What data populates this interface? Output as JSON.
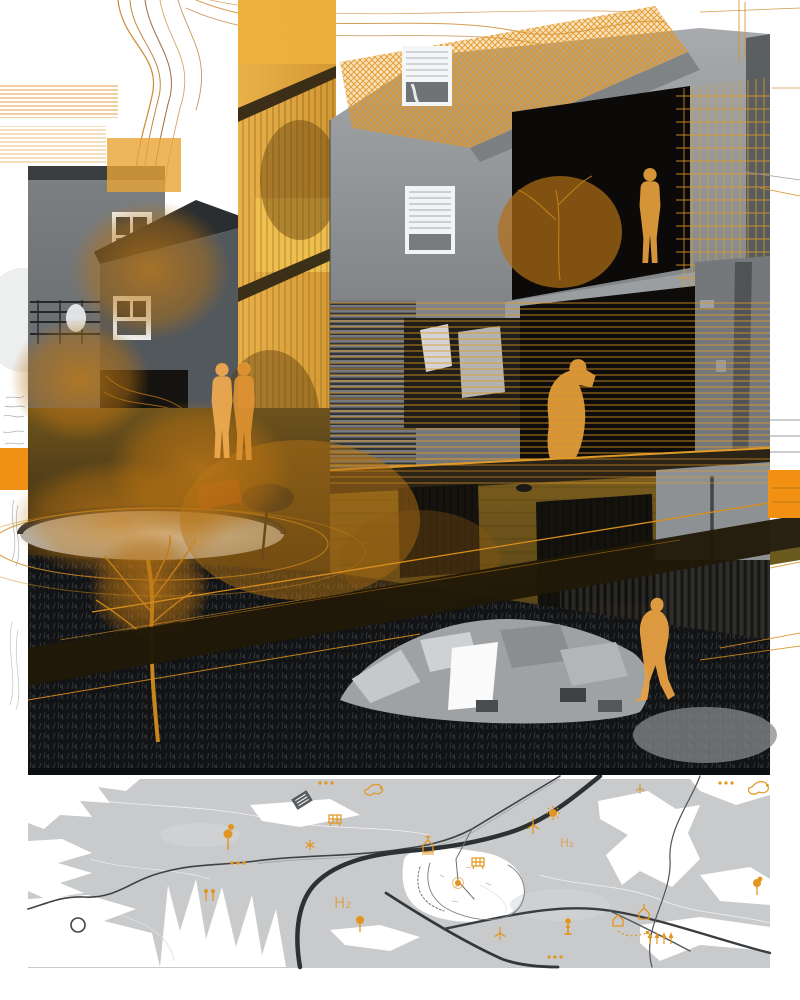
{
  "artwork": {
    "accent_orange": "#F29014",
    "hatch_orange": "#E09A28",
    "figure_orange": "#E8A041",
    "photo_dark": "#0d0c0a",
    "figure_names": [
      "standing-person-silhouette",
      "walking-pair-silhouette",
      "crouching-person-silhouette",
      "walking-person-silhouette"
    ]
  },
  "map": {
    "terrain_color": "#C9CACC",
    "road_color": "#2E3133",
    "icon_color": "#E2951F",
    "labels": {
      "h2_east": "H₂",
      "h2_west": "H₂"
    },
    "icon_names": [
      "sun-icon",
      "wind-turbine-icon",
      "tree-icon",
      "house-icon",
      "solar-panel-icon",
      "person-icon",
      "building-icon",
      "settlement-dot-icon",
      "plan-outline-icon",
      "three-dots-icon",
      "pins-icon",
      "asterisk-icon"
    ]
  }
}
